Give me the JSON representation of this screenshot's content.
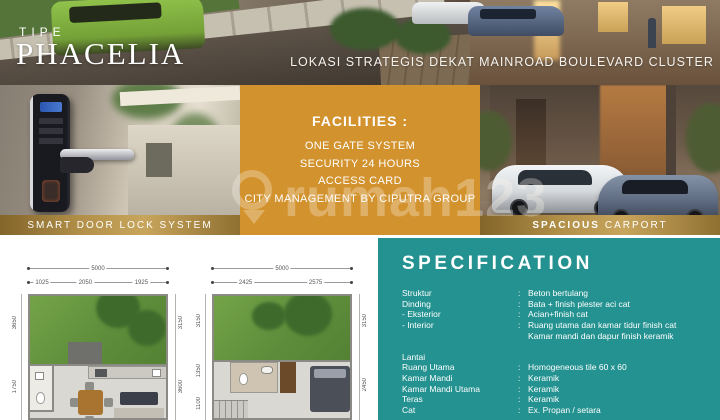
{
  "banner": {
    "tipe_label": "TIPE",
    "title": "PHACELIA",
    "tagline": "LOKASI STRATEGIS DEKAT MAINROAD BOULEVARD CLUSTER"
  },
  "panels": {
    "door_lock": {
      "caption": "SMART DOOR LOCK SYSTEM"
    },
    "facilities": {
      "title": "FACILITIES :",
      "items": [
        "ONE GATE SYSTEM",
        "SECURITY 24 HOURS",
        "ACCESS CARD",
        "CITY MANAGEMENT BY CIPUTRA GROUP"
      ]
    },
    "carport": {
      "caption_bold": "SPACIOUS",
      "caption_rest": "CARPORT"
    }
  },
  "watermark": {
    "text": "rumah123"
  },
  "floorplans": [
    {
      "top_total": "5000",
      "top_segments": [
        "1025",
        "2050",
        "1925"
      ],
      "left_dims": [
        "3650",
        "1750"
      ],
      "right_dims": [
        "3150",
        "3600"
      ]
    },
    {
      "top_total": "5000",
      "top_segments": [
        "2425",
        "2575"
      ],
      "left_dims": [
        "3150",
        "1350",
        "1100"
      ],
      "right_dims": [
        "3150",
        "2450"
      ]
    }
  ],
  "specification": {
    "title": "SPECIFICATION",
    "colon": ":",
    "rows": [
      {
        "label": "Struktur",
        "value": "Beton bertulang"
      },
      {
        "label": "Dinding",
        "value": "Bata + finish plester aci cat"
      },
      {
        "label": "- Eksterior",
        "value": "Acian+finish cat"
      },
      {
        "label": "- Interior",
        "value": "Ruang utama dan kamar tidur finish cat"
      },
      {
        "label": "",
        "value": "Kamar mandi dan dapur finish keramik"
      },
      {
        "label": "Lantai",
        "value": ""
      },
      {
        "label": "Ruang Utama",
        "value": "Homogeneous tile 60 x 60"
      },
      {
        "label": "Kamar Mandi",
        "value": "Keramik"
      },
      {
        "label": "Kamar Mandi Utama",
        "value": "Keramik"
      },
      {
        "label": "Teras",
        "value": "Keramik"
      },
      {
        "label": "Cat",
        "value": "Ex. Propan / setara"
      }
    ]
  },
  "colors": {
    "accent_orange": "#d2922e",
    "accent_teal": "#239290",
    "caption_gold": "#b3914a"
  }
}
